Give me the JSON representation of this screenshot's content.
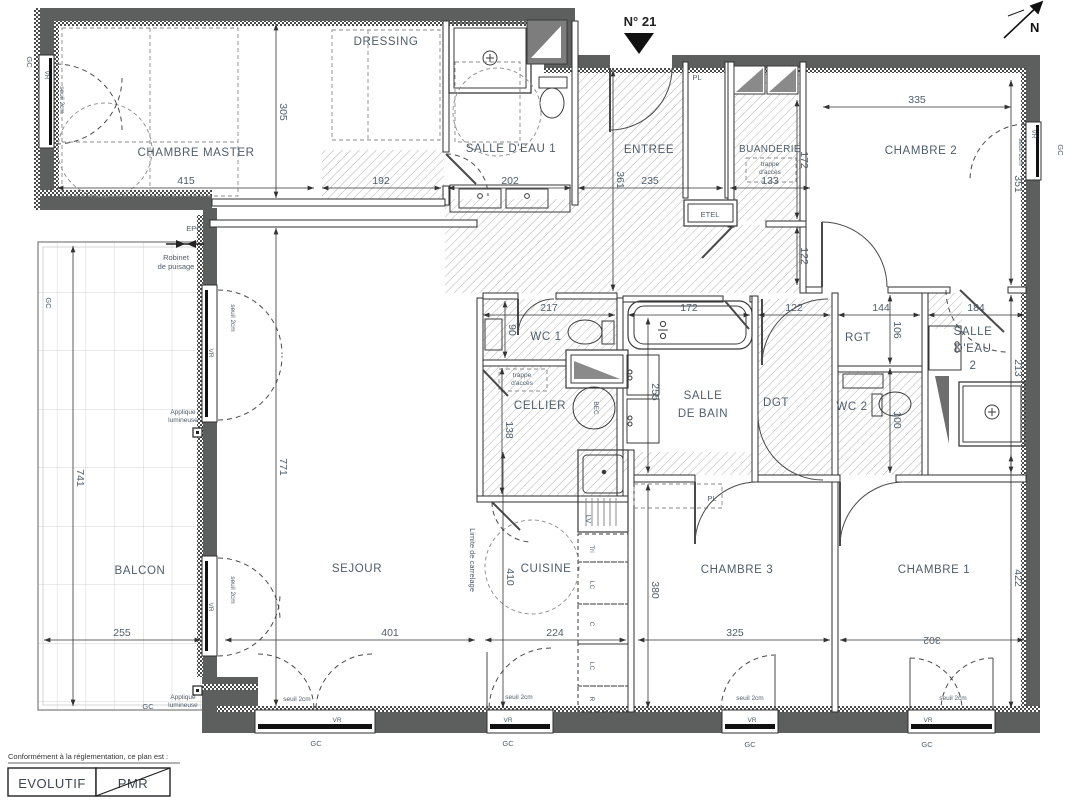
{
  "header": {
    "unit": "N° 21",
    "north": "N"
  },
  "rooms": {
    "chambre_master": {
      "label": "CHAMBRE MASTER",
      "width": "415",
      "height": "305"
    },
    "dressing": {
      "label": "DRESSING",
      "width": "192"
    },
    "salle_eau_1": {
      "label": "SALLE D'EAU 1",
      "width": "202"
    },
    "entree": {
      "label": "ENTREE",
      "width": "235",
      "height": "361"
    },
    "buanderie": {
      "label": "BUANDERIE",
      "note_1": "trappe",
      "note_2": "d'accès",
      "width": "133",
      "height": "172"
    },
    "couloir": {
      "height": "122"
    },
    "chambre_2": {
      "label": "CHAMBRE 2",
      "width": "335",
      "height": "351"
    },
    "wc_1": {
      "label": "WC 1",
      "width": "217",
      "height": "90"
    },
    "cellier": {
      "label": "CELLIER",
      "note_1": "trappe",
      "note_2": "d'accès",
      "height": "138"
    },
    "salle_de_bain": {
      "label_1": "SALLE",
      "label_2": "DE BAIN",
      "bath_width": "172",
      "height": "255"
    },
    "dgt": {
      "label": "DGT",
      "width": "122"
    },
    "rgt": {
      "label": "RGT",
      "width": "144",
      "height": "106"
    },
    "wc_2": {
      "label": "WC 2",
      "height": "100"
    },
    "salle_eau_2": {
      "label_1": "SALLE",
      "label_2": "D'EAU",
      "label_3": "2",
      "width": "184",
      "height": "213"
    },
    "chambre_3": {
      "label": "CHAMBRE 3",
      "width": "325",
      "height": "380"
    },
    "chambre_1": {
      "label": "CHAMBRE 1",
      "width": "302",
      "height": "422"
    },
    "sejour": {
      "label": "SEJOUR",
      "width": "401",
      "height": "771"
    },
    "cuisine": {
      "label": "CUISINE",
      "width": "224",
      "height": "410"
    },
    "balcon": {
      "label": "BALCON",
      "width": "255",
      "height": "741"
    }
  },
  "annotations": {
    "gc": "GC",
    "vr": "VR",
    "epc": "EPC",
    "pl": "PL",
    "etel": "ETEL",
    "seuil": "seuil 2cm",
    "robinet_1": "Robinet",
    "robinet_2": "de puisage",
    "applique_1": "Applique",
    "applique_2": "lumineuse",
    "limite_carrelage": "Limite de carrelage",
    "bec": "BEC"
  },
  "kitchen": {
    "lv": "LV",
    "tri": "Tri",
    "lc": "LC",
    "c": "C",
    "r": "R"
  },
  "legend": {
    "caption": "Conformément à la réglementation, ce plan est :",
    "evolutif": "EVOLUTIF",
    "pmr": "PMR"
  },
  "colors": {
    "wall": "#5d5e5e",
    "label": "#4f5d6b",
    "hatch": "#b3b3b3"
  }
}
